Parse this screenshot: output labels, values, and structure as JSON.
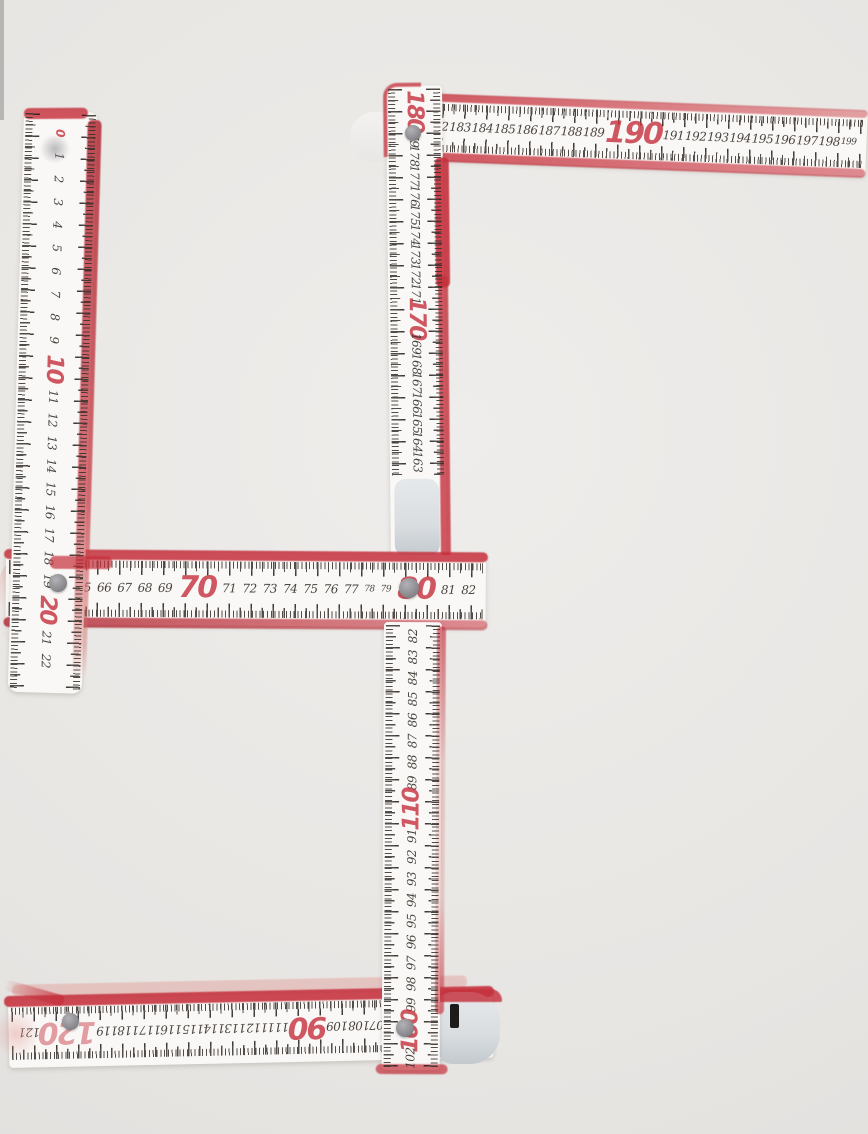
{
  "palette": {
    "paper": "#e8e6e3",
    "ruler_white": "#faf8f6",
    "red": "#c5303c",
    "deep_red": "#b02430",
    "pink": "#e2a39e",
    "tick": "#35302b",
    "rivet": "#8e8e93",
    "cap": "#d9dde0"
  },
  "segments": {
    "top_horizontal": {
      "numbers": [
        {
          "t": "181"
        },
        {
          "t": "182"
        },
        {
          "t": "183"
        },
        {
          "t": "184"
        },
        {
          "t": "185"
        },
        {
          "t": "186"
        },
        {
          "t": "187"
        },
        {
          "t": "188"
        },
        {
          "t": "189"
        },
        {
          "t": "190",
          "red": true,
          "big": true
        },
        {
          "t": "191"
        },
        {
          "t": "192"
        },
        {
          "t": "193"
        },
        {
          "t": "194"
        },
        {
          "t": "195"
        },
        {
          "t": "196"
        },
        {
          "t": "197"
        },
        {
          "t": "198"
        },
        {
          "t": "199",
          "small": true
        }
      ]
    },
    "upper_vertical": {
      "numbers": [
        {
          "t": "180",
          "red": true,
          "big": true
        },
        {
          "t": "179"
        },
        {
          "t": "178"
        },
        {
          "t": "177"
        },
        {
          "t": "176"
        },
        {
          "t": "175"
        },
        {
          "t": "174"
        },
        {
          "t": "173"
        },
        {
          "t": "172"
        },
        {
          "t": "171"
        },
        {
          "t": "170",
          "red": true,
          "big": true
        },
        {
          "t": "169"
        },
        {
          "t": "168"
        },
        {
          "t": "167"
        },
        {
          "t": "166"
        },
        {
          "t": "165"
        },
        {
          "t": "164"
        },
        {
          "t": "163"
        }
      ]
    },
    "left_vertical": {
      "numbers": [
        {
          "t": "0",
          "red": true
        },
        {
          "t": "1"
        },
        {
          "t": "2"
        },
        {
          "t": "3"
        },
        {
          "t": "4"
        },
        {
          "t": "5"
        },
        {
          "t": "6"
        },
        {
          "t": "7"
        },
        {
          "t": "8"
        },
        {
          "t": "9"
        },
        {
          "t": "10",
          "red": true,
          "big": true
        },
        {
          "t": "11"
        },
        {
          "t": "12"
        },
        {
          "t": "13"
        },
        {
          "t": "14"
        },
        {
          "t": "15"
        },
        {
          "t": "16"
        },
        {
          "t": "17"
        },
        {
          "t": "18"
        },
        {
          "t": "19"
        },
        {
          "t": "20",
          "red": true,
          "big": true
        },
        {
          "t": "21"
        },
        {
          "t": "22"
        }
      ]
    },
    "middle_horizontal": {
      "numbers": [
        {
          "t": "62"
        },
        {
          "t": "63"
        },
        {
          "t": "64"
        },
        {
          "t": "65"
        },
        {
          "t": "66"
        },
        {
          "t": "67"
        },
        {
          "t": "68"
        },
        {
          "t": "69"
        },
        {
          "t": "70",
          "red": true,
          "big": true
        },
        {
          "t": "71"
        },
        {
          "t": "72"
        },
        {
          "t": "73"
        },
        {
          "t": "74"
        },
        {
          "t": "75"
        },
        {
          "t": "76"
        },
        {
          "t": "77"
        },
        {
          "t": "78",
          "small": true
        },
        {
          "t": "79",
          "small": true
        },
        {
          "t": "80",
          "red": true,
          "big": true
        },
        {
          "t": "81"
        },
        {
          "t": "82"
        }
      ]
    },
    "lower_vertical": {
      "numbers": [
        {
          "t": "82"
        },
        {
          "t": "83"
        },
        {
          "t": "84"
        },
        {
          "t": "85"
        },
        {
          "t": "86"
        },
        {
          "t": "87"
        },
        {
          "t": "88"
        },
        {
          "t": "89"
        },
        {
          "t": "110",
          "red": true,
          "big": true
        },
        {
          "t": "91"
        },
        {
          "t": "92"
        },
        {
          "t": "93"
        },
        {
          "t": "94"
        },
        {
          "t": "95"
        },
        {
          "t": "96"
        },
        {
          "t": "97"
        },
        {
          "t": "98"
        },
        {
          "t": "99"
        },
        {
          "t": "100",
          "red": true,
          "big": true
        },
        {
          "t": "102"
        }
      ]
    },
    "bottom_horizontal": {
      "numbers": [
        {
          "t": "121"
        },
        {
          "t": "120",
          "red": true,
          "big": true,
          "pale": true
        },
        {
          "t": "119"
        },
        {
          "t": "118"
        },
        {
          "t": "117"
        },
        {
          "t": "116"
        },
        {
          "t": "115"
        },
        {
          "t": "114"
        },
        {
          "t": "113"
        },
        {
          "t": "112"
        },
        {
          "t": "111"
        },
        {
          "t": "90",
          "red": true,
          "big": true
        },
        {
          "t": "109"
        },
        {
          "t": "108"
        },
        {
          "t": "107"
        },
        {
          "t": "106"
        },
        {
          "t": "105"
        },
        {
          "t": "104"
        },
        {
          "t": "103"
        },
        {
          "t": "102"
        }
      ]
    }
  }
}
